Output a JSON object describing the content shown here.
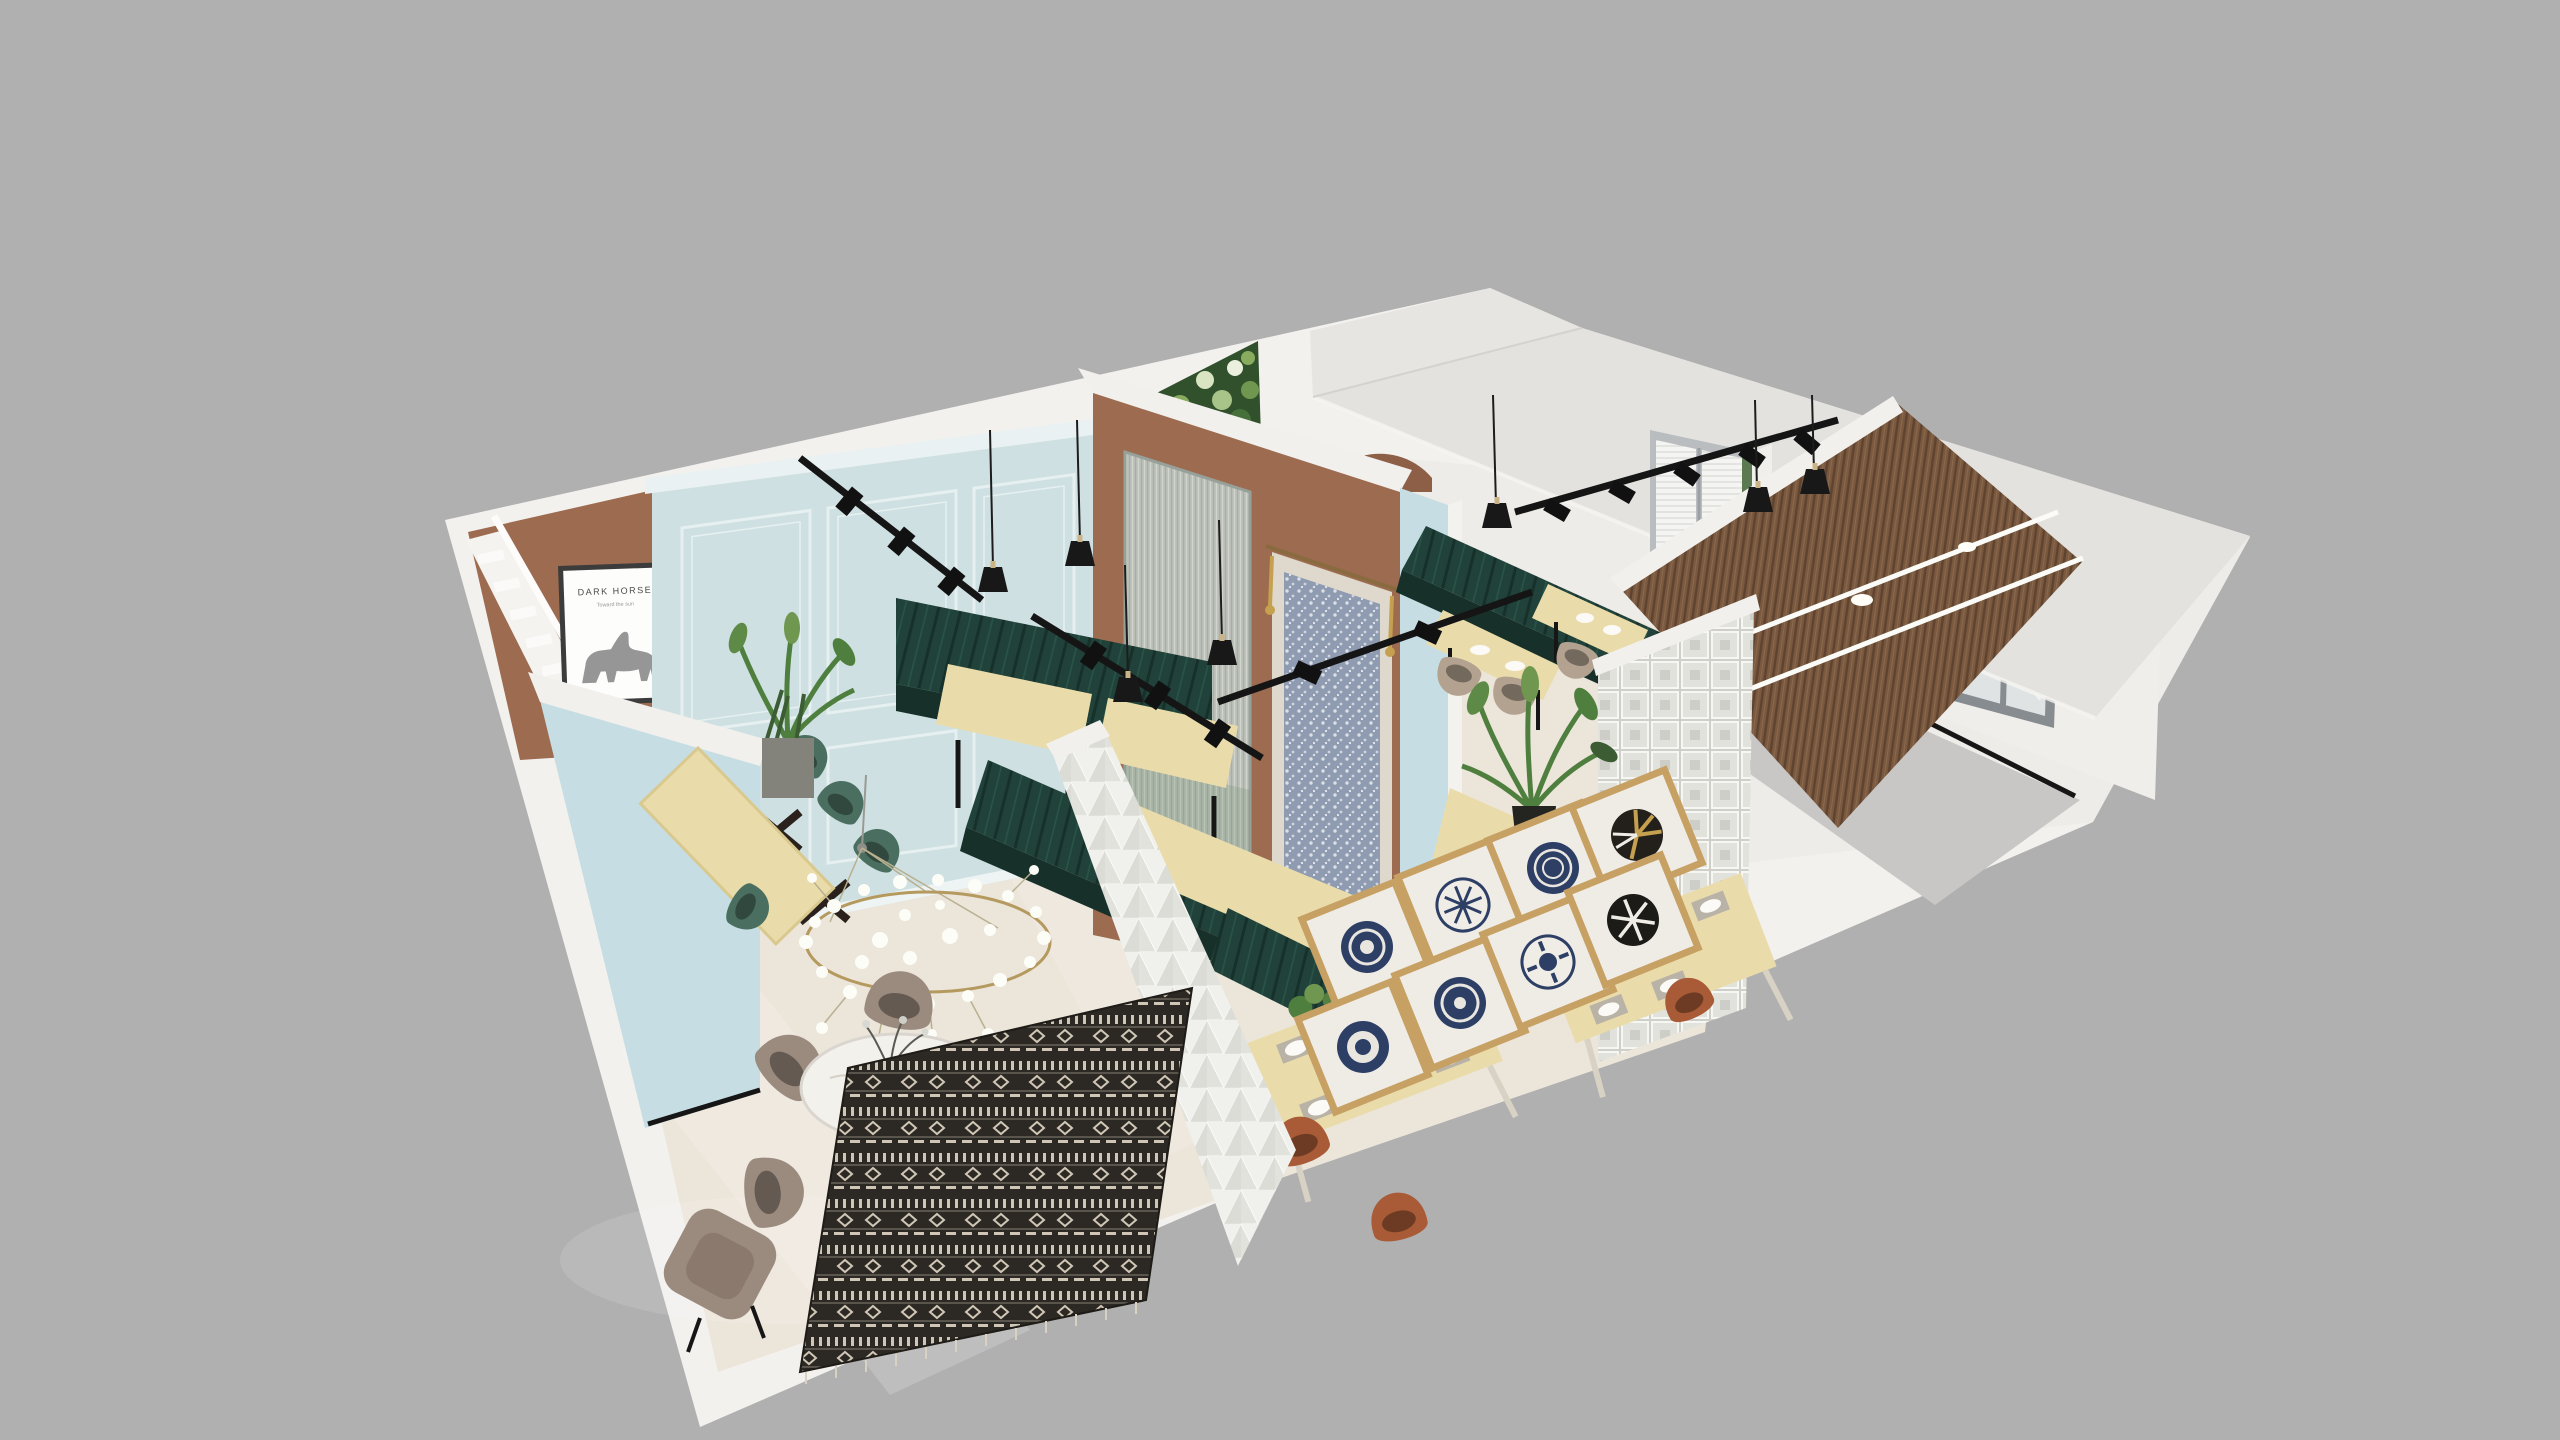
{
  "scene": {
    "kind": "3d-interior-render",
    "view": "isometric-dollhouse-cutaway",
    "subject": "cafe-restaurant floor visualization on gray backdrop"
  },
  "poster": {
    "title": "DARK HORSE",
    "subtitle": "Toward the sun"
  },
  "palette": {
    "background": "#b0b0b0",
    "cut_wall": "#f3f1ee",
    "wall_white": "#eeece8",
    "slab": "#e3e2df",
    "floor_cream": "#ece5da",
    "floor_gray": "#c8c7c5",
    "terracotta": "#9c6b50",
    "terracotta_deep": "#8d5f46",
    "blue_panel": "#cfe0e2",
    "blue_partition": "#c6dee3",
    "booth_green": "#20423a",
    "booth_green_dark": "#17312a",
    "wood": "#eadcaa",
    "marble": "#f3f1ec",
    "chair_rust": "#a85b36",
    "chair_taupe": "#9b8b7e",
    "chair_beige": "#b3a28f",
    "chair_green": "#4a6f60",
    "slat_brown": "#7a593f",
    "slat_brown_line": "#5e4330",
    "black": "#1a1a1a",
    "frame_wood": "#c7a164",
    "plate_navy": "#2e3f66",
    "gold": "#c5a04e",
    "glass_flute": "#bfc7c0",
    "glass_block": "#d8d8d4",
    "plant_green": "#4f7f3e",
    "textile_dark": "#2c2823",
    "textile_cream": "#cfc6b6",
    "led": "#fbfbf7"
  },
  "inventory": {
    "areas": [
      {
        "name": "stairwell",
        "features": [
          "white staircase",
          "terracotta accent wall",
          "framed horse poster",
          "two black pendant lamps"
        ]
      },
      {
        "name": "booth-dining-area",
        "features": [
          "pale-blue classical paneled wall",
          "dark-green channel-tufted booths",
          "light wood tables",
          "black track lights",
          "fluted glass panel",
          "terracotta partition",
          "floral tapestry with tassels"
        ]
      },
      {
        "name": "back-banquette-area",
        "features": [
          "long green banquette",
          "two wood tables",
          "beige chairs",
          "glass door with white blinds",
          "green plant wall",
          "arched niche",
          "ceiling slab with cutout"
        ]
      },
      {
        "name": "gallery-dining-area",
        "features": [
          "wall of 8 framed decorative plates",
          "light wood tables with place settings",
          "rust-terracotta chairs",
          "white 3D pyramid partition",
          "glass-block wall",
          "potted palm"
        ]
      },
      {
        "name": "lounge-area",
        "features": [
          "round marble table",
          "taupe velvet chairs",
          "armchair",
          "branch chandelier with white florets",
          "black-and-white tribal textile panel",
          "long wood table",
          "green velvet chairs",
          "planter with palm"
        ]
      },
      {
        "name": "entry-corridor",
        "features": [
          "gray floor",
          "window with gray frame",
          "dark wood slat wall",
          "two diagonal LED light strips",
          "recessed downlights",
          "black baseboards"
        ]
      }
    ],
    "lighting": [
      "track lights (4 runs)",
      "black bell pendant lamps (9)",
      "branch chandelier",
      "LED strips on slat wall (2)",
      "recessed downlights (2)"
    ],
    "decor_plates": [
      "navy-ring",
      "white-snowflake",
      "navy-ring",
      "black-gold-wedge",
      "navy-mandala",
      "navy-ring",
      "white-floral",
      "black-spoke"
    ]
  }
}
